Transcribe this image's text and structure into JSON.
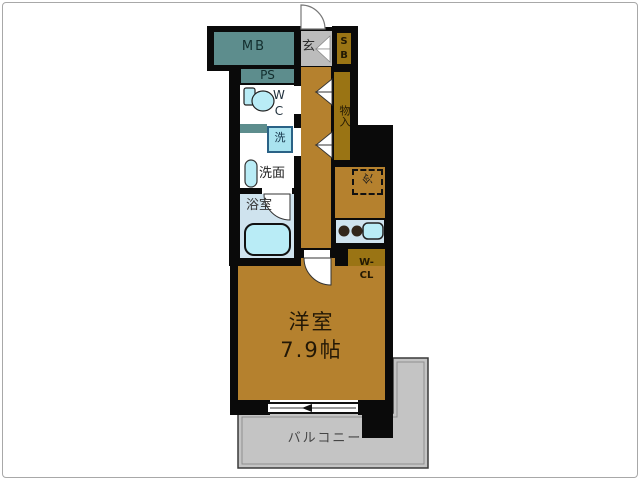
{
  "plan": {
    "title": "apartment-floor-plan",
    "labels": {
      "mb": "MB",
      "ps": "PS",
      "sb": "S\nB",
      "genkan": "玄",
      "wc": "W\nC",
      "washer": "洗",
      "washroom": "洗面",
      "bathroom": "浴室",
      "storage": "物入",
      "fridge": "冷",
      "wcl": "W-\nCL",
      "main_room": "洋室\n7.9帖",
      "balcony": "バルコニー"
    },
    "colors": {
      "wall": "#0a0a0a",
      "room_brown": "#b5812e",
      "closet_olive": "#9a7414",
      "teal": "#5d8d8d",
      "gray": "#c4c4c4",
      "entry_gray": "#bcbcbc",
      "bath_bg": "#cfe3ee",
      "fixture_blue": "#b9ecf6",
      "washer_blue": "#a9e3ef"
    }
  }
}
